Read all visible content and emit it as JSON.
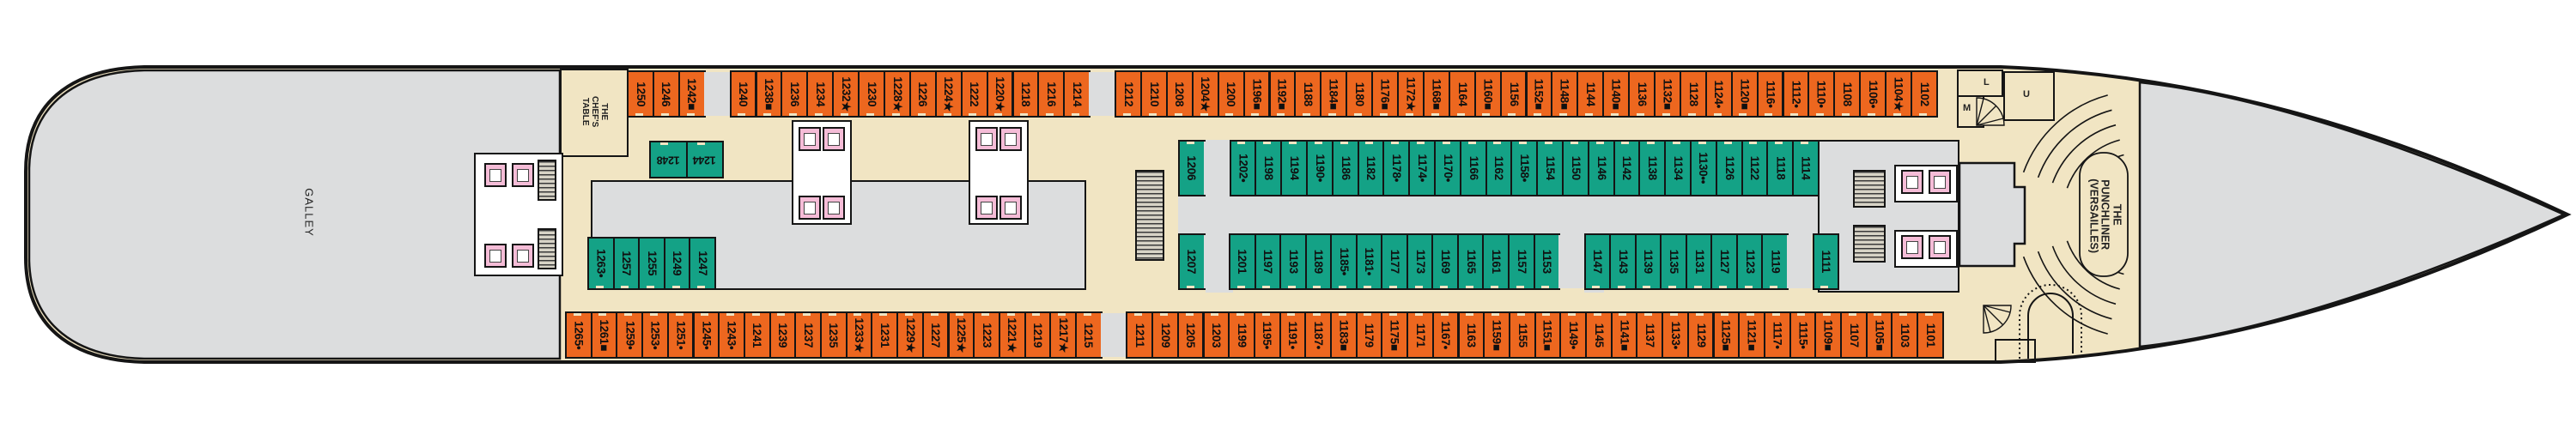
{
  "areas": {
    "galley": "GALLEY",
    "chefs_table": "THE CHEF'S TABLE",
    "theater": "THE PUNCHLINER (VERSAILLES)"
  },
  "elevators": [
    "L",
    "U",
    "M"
  ],
  "colors": {
    "oceanview_cabin": "#ED671F",
    "interior_cabin": "#14A286",
    "corridor": "#F1E5C3",
    "public_space": "#DCDDDE",
    "facility": "#F5BCD7"
  },
  "cabin_rows": {
    "port_outer": [
      "1250",
      "1246",
      "1242■",
      "",
      "1240",
      "1238■",
      "1236",
      "1234",
      "1232★",
      "1230",
      "1228★",
      "1226",
      "1224★",
      "1222",
      "1220★",
      "1218",
      "1216",
      "1214",
      "",
      "1212",
      "1210",
      "1208",
      "1204★",
      "1200",
      "1196■",
      "1192■",
      "1188",
      "1184■",
      "1180",
      "1176■",
      "1172★",
      "1168■",
      "1164",
      "1160■",
      "1156",
      "1152■",
      "1148■",
      "1144",
      "1140■",
      "1136",
      "1132■",
      "1128",
      "1124•",
      "1120■",
      "1116•",
      "1112•",
      "1110•",
      "1108",
      "1106•",
      "1104★",
      "1102"
    ],
    "port_inner": [
      "1206",
      "",
      "1202•",
      "1198",
      "1194",
      "1190•",
      "1186",
      "1182",
      "1178•",
      "1174•",
      "1170•",
      "1166",
      "1162",
      "1158•",
      "1154",
      "1150",
      "1146",
      "1142",
      "1138",
      "1134",
      "1130••",
      "1126",
      "1122",
      "1118",
      "1114"
    ],
    "stbd_inner": [
      "1207",
      "",
      "1201",
      "1197",
      "1193",
      "1189",
      "1185•",
      "1181•",
      "1177",
      "1173",
      "1169",
      "1165",
      "1161",
      "1157",
      "1153",
      "",
      "1147",
      "1143",
      "1139",
      "1135",
      "1131",
      "1127",
      "1123",
      "1119",
      "",
      "1111"
    ],
    "stbd_outer": [
      "1265•",
      "1261■",
      "1259•",
      "1253•",
      "1251•",
      "1245•",
      "1243•",
      "1241",
      "1239",
      "1237",
      "1235",
      "1233★",
      "1231",
      "1229★",
      "1227",
      "1225★",
      "1223",
      "1221★",
      "1219",
      "1217★",
      "1215",
      "",
      "1211",
      "1209",
      "1205",
      "1203",
      "1199",
      "1195•",
      "1191•",
      "1187•",
      "1183■",
      "1179",
      "1175■",
      "1171",
      "1167•",
      "1163",
      "1159■",
      "1155",
      "1151■",
      "1149•",
      "1145",
      "1141■",
      "1137",
      "1133•",
      "1129",
      "1125■",
      "1121■",
      "1117•",
      "1115•",
      "1109■",
      "1107",
      "1105■",
      "1103",
      "1101"
    ],
    "aft_inner_top": [
      "1248",
      "1244"
    ],
    "aft_inner_bottom": [
      "1263•",
      "1257",
      "1255",
      "1249",
      "1247"
    ]
  }
}
